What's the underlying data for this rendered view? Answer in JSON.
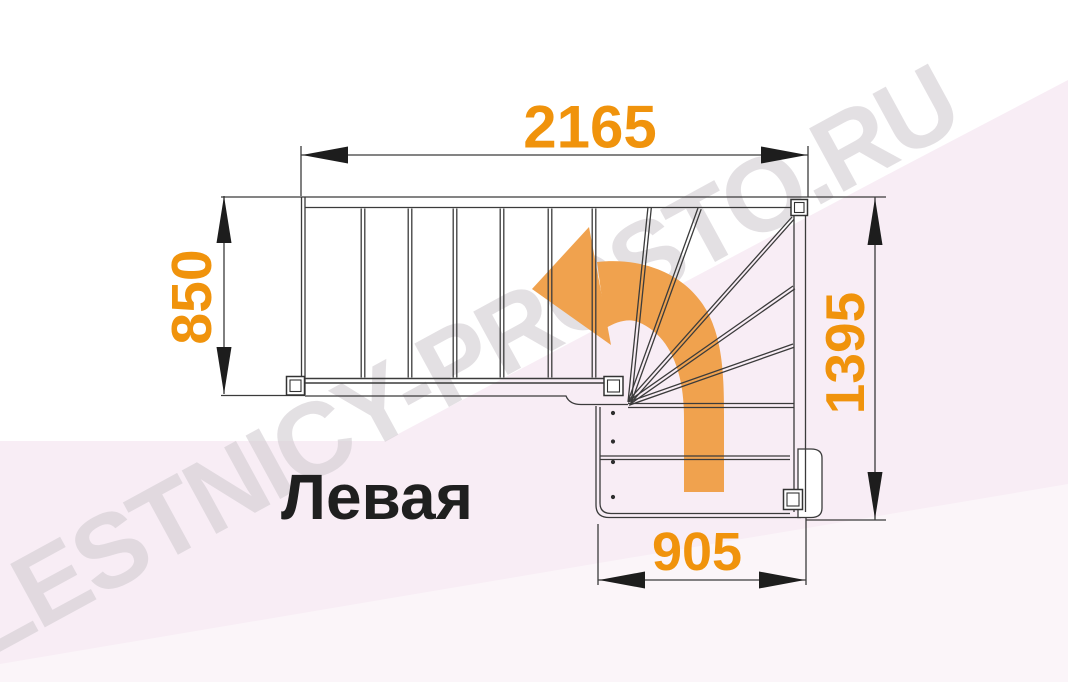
{
  "diagram": {
    "orientation_label": "Левая",
    "watermark": "LESTNICY-PROSTO.RU",
    "dimensions": {
      "top_width": "2165",
      "left_depth": "850",
      "right_height": "1395",
      "bottom_width": "905"
    },
    "colors": {
      "dimension_text": "#F0930C",
      "direction_arrow": "#F0A24E",
      "drawing_line": "#3B3B3B",
      "watermark": "#D2CDD2",
      "background_tint": "#F8EDF5"
    },
    "icons": {
      "direction_arrow": "curved-left-turn-arrow"
    }
  }
}
